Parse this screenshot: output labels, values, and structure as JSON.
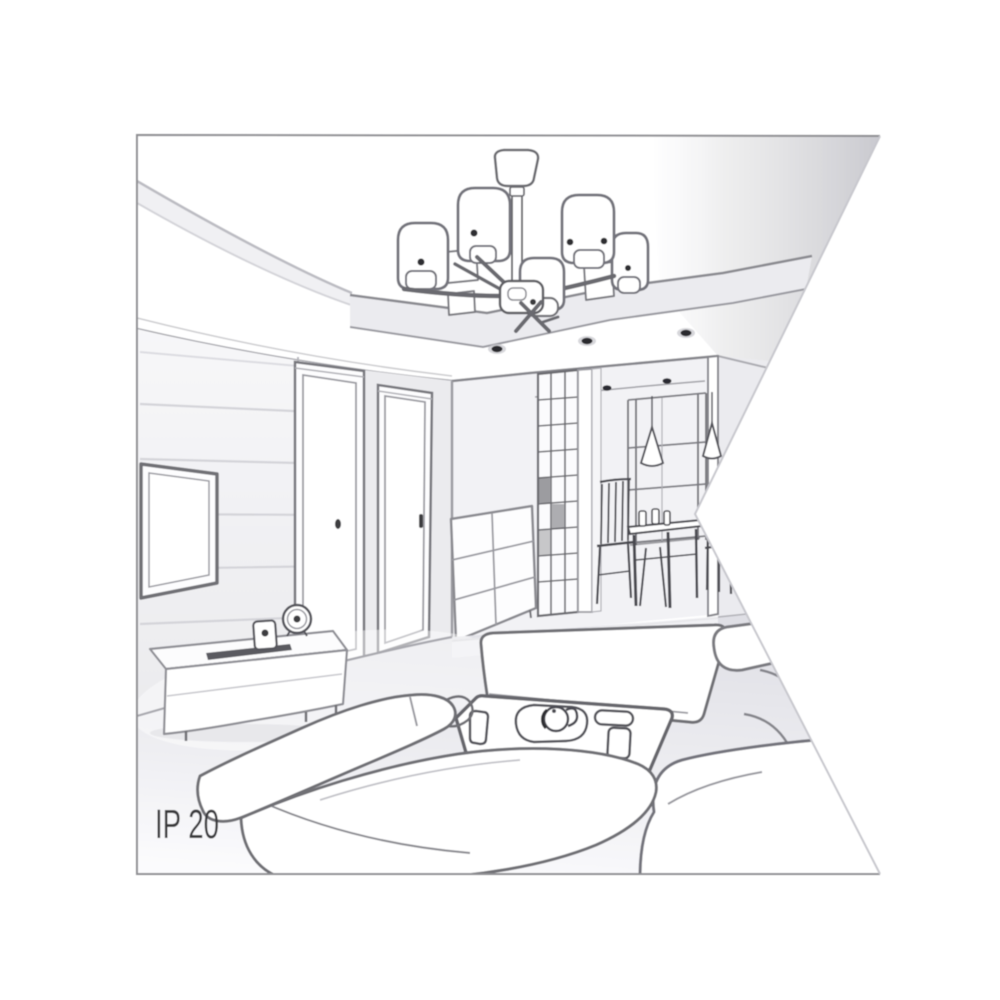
{
  "illustration": {
    "ip_rating_label": "IP 20",
    "scene": "living-room-interior-sketch",
    "elements": [
      "ceiling-chandelier-icon",
      "recessed-spotlight-icon",
      "wall-tv-icon",
      "tv-stand-icon",
      "alarm-clock-icon",
      "interior-door-icon",
      "drawer-chest-icon",
      "hallway-shelving-icon",
      "pendant-lamp-icon",
      "dining-table-icon",
      "dining-chair-icon",
      "window-icon",
      "sofa-icon",
      "coffee-table-icon",
      "tea-tray-icon"
    ],
    "colors": {
      "background": "#ffffff",
      "frame_border": "#8f8f93",
      "notch_edge": "#c8c8ce",
      "sketch_line_dark": "#55555b",
      "sketch_line_mid": "#8a8a90",
      "sketch_line_soft": "#c4c4ca",
      "shading_light": "#ebebef",
      "shading_mid": "#d2d2d8",
      "accent_dark": "#2c2c30",
      "label_text": "#3a3a3e"
    }
  }
}
